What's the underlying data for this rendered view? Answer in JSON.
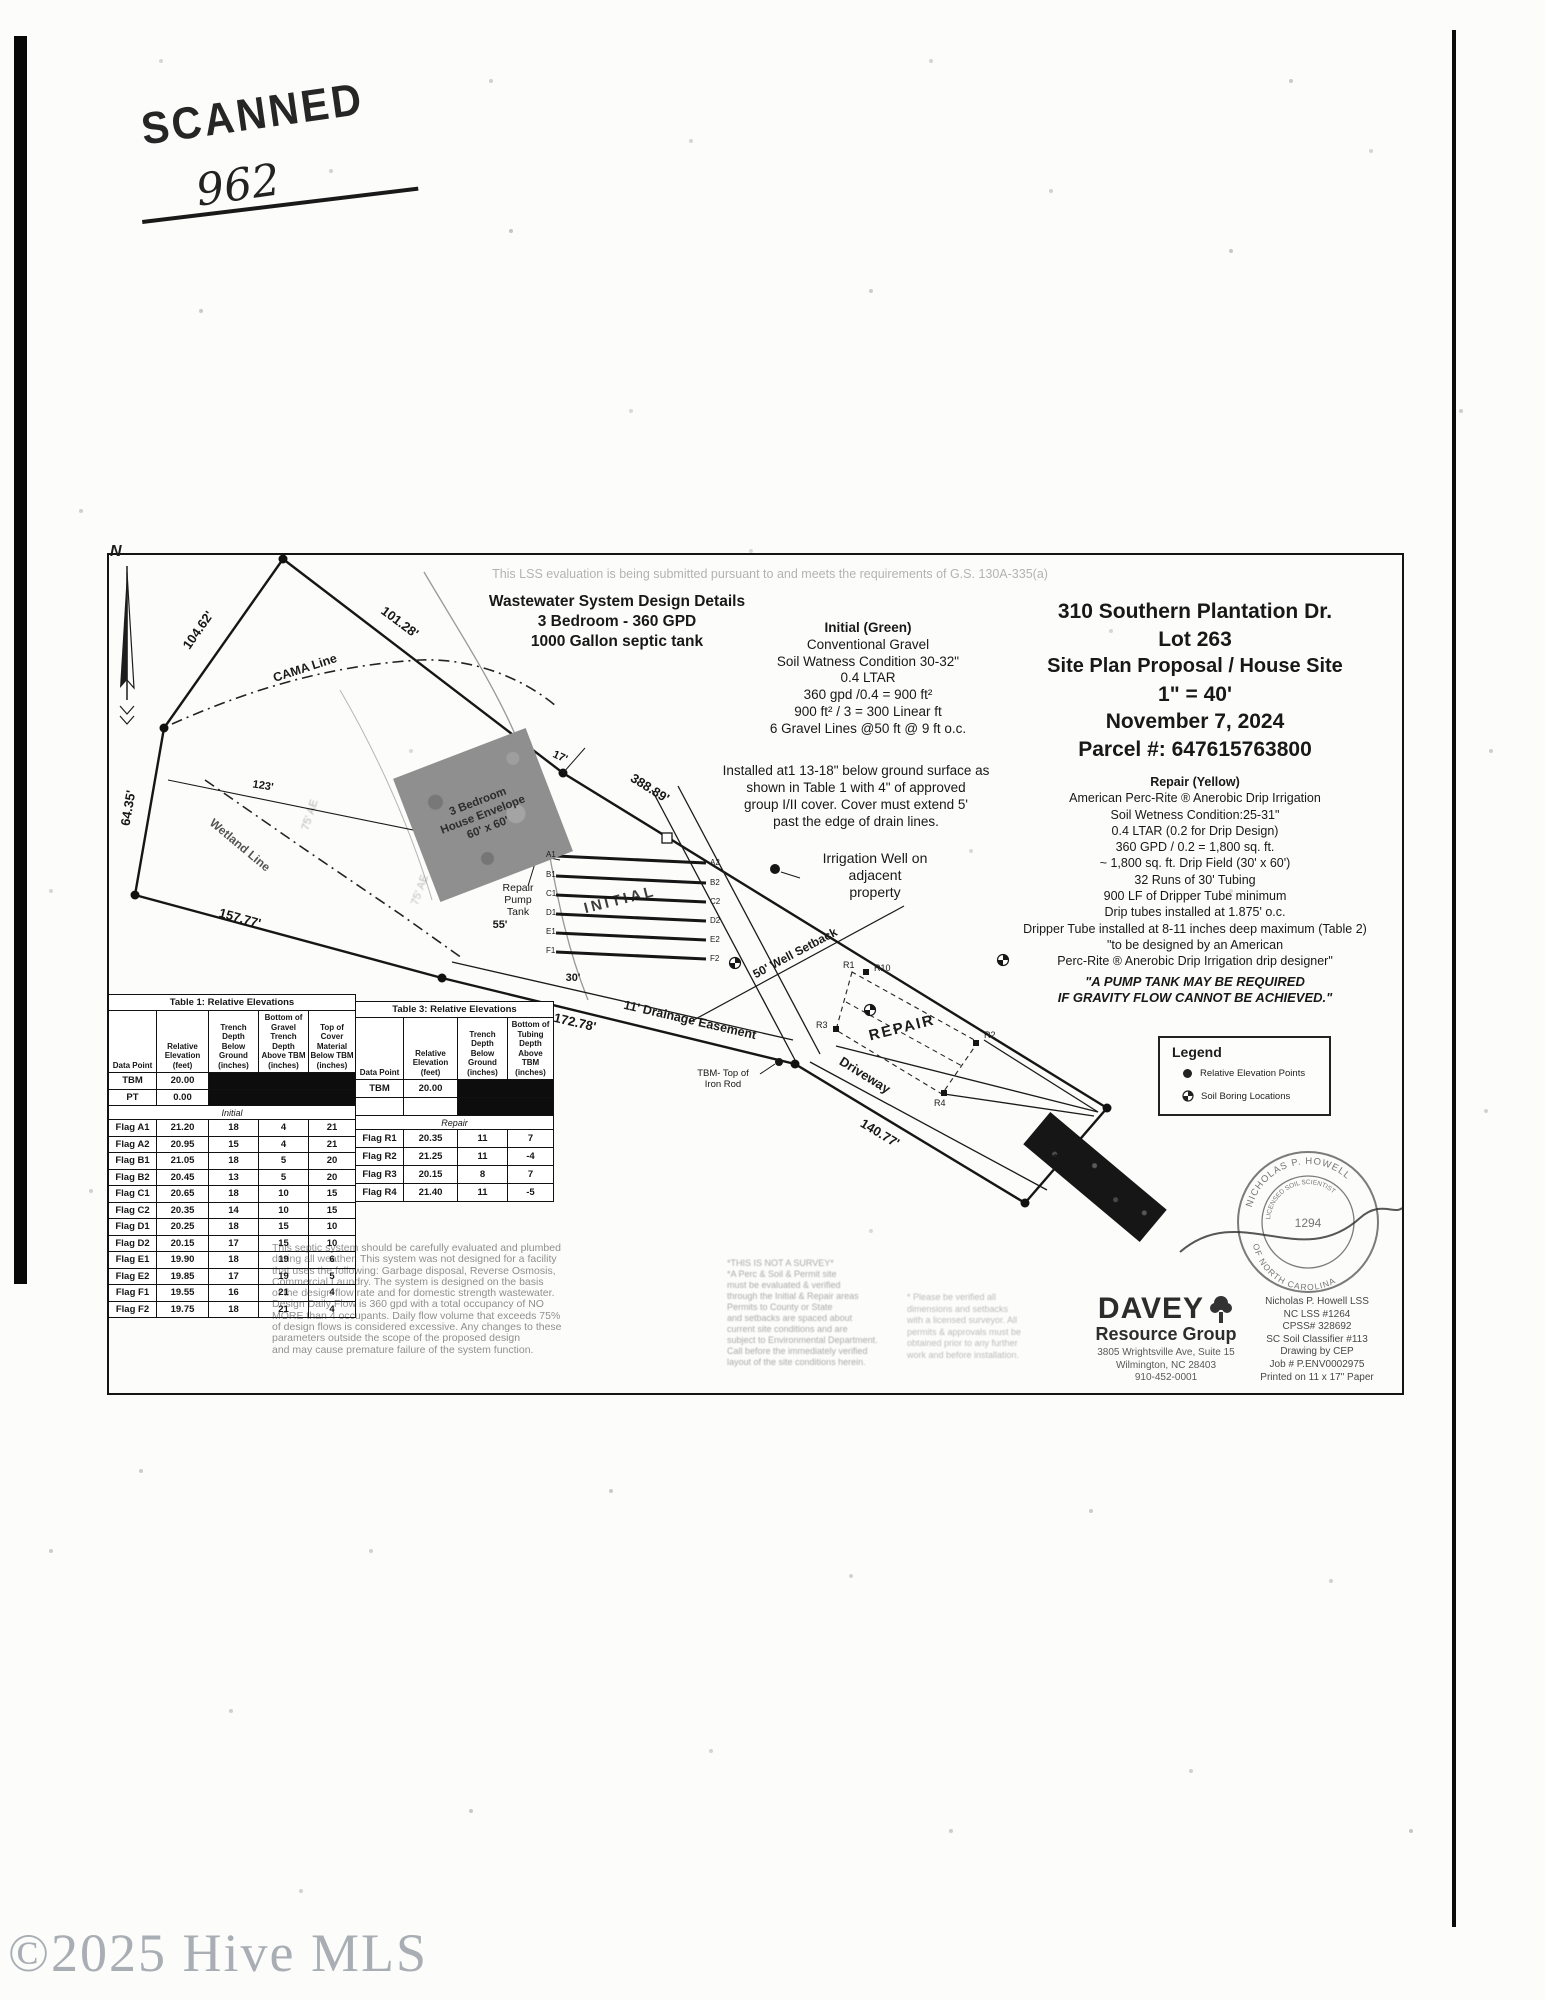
{
  "stamp": {
    "scanned": "SCANNED",
    "number": "962"
  },
  "watermark": "©2025 Hive MLS",
  "plan": {
    "compliance_note": "This LSS evaluation is being submitted pursuant to and meets the requirements of G.S. 130A-335(a)",
    "north": "N",
    "design": {
      "l1": "Wastewater System Design Details",
      "l2": "3 Bedroom - 360 GPD",
      "l3": "1000 Gallon septic tank"
    },
    "initial": {
      "title": "Initial (Green)",
      "lines": [
        "Conventional Gravel",
        "Soil Watness Condition 30-32\"",
        "0.4 LTAR",
        "360 gpd /0.4 = 900 ft²",
        "900 ft² / 3 = 300 Linear ft",
        "6 Gravel Lines @50 ft @ 9 ft o.c."
      ],
      "note": [
        "Installed at1 13-18\" below ground surface as",
        "shown in Table 1 with 4\" of approved",
        "group I/II cover. Cover must extend 5'",
        "past the edge of drain lines."
      ]
    },
    "title_block": {
      "address": "310 Southern Plantation Dr.",
      "lot": "Lot 263",
      "subtitle": "Site Plan Proposal / House Site",
      "scale": "1\" = 40'",
      "date": "November 7, 2024",
      "parcel": "Parcel #: 647615763800"
    },
    "repair": {
      "title": "Repair (Yellow)",
      "lines": [
        "American Perc-Rite ® Anerobic Drip Irrigation",
        "Soil Wetness Condition:25-31\"",
        "0.4 LTAR (0.2 for Drip Design)",
        "360 GPD / 0.2 = 1,800 sq. ft.",
        "~ 1,800 sq. ft. Drip Field (30' x 60')",
        "32 Runs of 30' Tubing",
        "900 LF of Dripper Tube minimum",
        "Drip tubes installed at 1.875' o.c.",
        "Dripper Tube installed at 8-11 inches deep maximum (Table 2)",
        "\"to be designed by an American",
        "Perc-Rite ® Anerobic Drip Irrigation drip designer\""
      ],
      "warn1": "\"A PUMP TANK MAY BE REQUIRED",
      "warn2": "IF GRAVITY FLOW CANNOT BE ACHIEVED.\""
    },
    "labels": {
      "d10462": "104.62'",
      "d10128": "101.28'",
      "d6435": "64.35'",
      "d15777": "157.77'",
      "d17278": "172.78'",
      "d14077": "140.77'",
      "d6262": "62.62'",
      "d38889": "388.89'",
      "d17": "17'",
      "d123": "123'",
      "d55": "55'",
      "d30": "30'",
      "cama": "CAMA Line",
      "wetland": "Wetland Line",
      "stream": "75' AE",
      "env1": "3 Bedroom",
      "env2": "House Envelope",
      "env3": "60' x 60'",
      "pump1": "Repair",
      "pump2": "Pump",
      "pump3": "Tank",
      "initial_field": "INITIAL",
      "repair_field": "REPAIR",
      "easement": "11' Drainage Easement",
      "well1": "Irrigation Well on",
      "well2": "adjacent",
      "well3": "property",
      "setback": "50' Well Setback",
      "driveway": "Driveway",
      "tbm1": "TBM- Top of",
      "tbm2": "Iron Rod"
    },
    "flags": {
      "left": [
        "A1",
        "B1",
        "C1",
        "D1",
        "E1",
        "F1"
      ],
      "right": [
        "A2",
        "B2",
        "C2",
        "D2",
        "E2",
        "F2"
      ],
      "r1": "R1",
      "r10": "R10",
      "r2": "R2",
      "r3": "R3",
      "r4": "R4"
    }
  },
  "legend": {
    "title": "Legend",
    "item1": "Relative Elevation Points",
    "item2": "Soil Boring Locations"
  },
  "table1": {
    "title": "Table 1: Relative Elevations",
    "columns": [
      "Data Point",
      "Relative Elevation (feet)",
      "Trench Depth Below Ground (inches)",
      "Bottom of Gravel Trench Depth Above TBM (inches)",
      "Top of Cover Material Below TBM (inches)"
    ],
    "tbm": [
      "TBM",
      "20.00"
    ],
    "pt": [
      "PT",
      "0.00"
    ],
    "section": "Initial",
    "rows": [
      [
        "Flag A1",
        "21.20",
        "18",
        "4",
        "21"
      ],
      [
        "Flag A2",
        "20.95",
        "15",
        "4",
        "21"
      ],
      [
        "Flag B1",
        "21.05",
        "18",
        "5",
        "20"
      ],
      [
        "Flag B2",
        "20.45",
        "13",
        "5",
        "20"
      ],
      [
        "Flag C1",
        "20.65",
        "18",
        "10",
        "15"
      ],
      [
        "Flag C2",
        "20.35",
        "14",
        "10",
        "15"
      ],
      [
        "Flag D1",
        "20.25",
        "18",
        "15",
        "10"
      ],
      [
        "Flag D2",
        "20.15",
        "17",
        "15",
        "10"
      ],
      [
        "Flag E1",
        "19.90",
        "18",
        "19",
        "6"
      ],
      [
        "Flag E2",
        "19.85",
        "17",
        "19",
        "5"
      ],
      [
        "Flag F1",
        "19.55",
        "16",
        "21",
        "4"
      ],
      [
        "Flag F2",
        "19.75",
        "18",
        "21",
        "4"
      ]
    ]
  },
  "table3": {
    "title": "Table 3: Relative Elevations",
    "columns": [
      "Data Point",
      "Relative Elevation (feet)",
      "Trench Depth Below Ground (inches)",
      "Bottom of Tubing Depth Above TBM (inches)"
    ],
    "tbm": [
      "TBM",
      "20.00"
    ],
    "section": "Repair",
    "rows": [
      [
        "Flag R1",
        "20.35",
        "11",
        "7"
      ],
      [
        "Flag R2",
        "21.25",
        "11",
        "-4"
      ],
      [
        "Flag R3",
        "20.15",
        "8",
        "7"
      ],
      [
        "Flag R4",
        "21.40",
        "11",
        "-5"
      ]
    ]
  },
  "disclaimer": {
    "lines": [
      "This septic system should be carefully evaluated and plumbed",
      "during all weather. This system was not designed for a facility",
      "that uses the following: Garbage disposal, Reverse Osmosis,",
      "Commercial Laundry. The system is designed on the basis",
      "of the design flow rate and for domestic strength wastewater.",
      "Design Daily Flow is 360 gpd with a total occupancy of NO",
      "MORE than 4 occupants. Daily flow volume that exceeds 75%",
      "of design flows is considered excessive. Any changes to these",
      "parameters outside the scope of the proposed design",
      "and may cause premature failure of the system function."
    ]
  },
  "notes": {
    "note1_lines": [
      "*THIS IS NOT A SURVEY*",
      "*A Perc & Soil & Permit site",
      "must be evaluated & verified",
      "through the Initial & Repair areas",
      "Permits to County or State",
      "and setbacks are spaced about",
      "current site conditions and are",
      "subject to Environmental Department.",
      "Call before the immediately verified",
      "layout of the site conditions herein."
    ],
    "note2_lines": [
      "* Please be verified all",
      "dimensions and setbacks",
      "with a licensed surveyor. All",
      "permits & approvals must be",
      "obtained prior to any further",
      "work and before installation."
    ]
  },
  "firm": {
    "name": "DAVEY",
    "division": "Resource Group",
    "addr1": "3805 Wrightsville Ave, Suite 15",
    "addr2": "Wilmington, NC 28403",
    "phone": "910-452-0001"
  },
  "credentials": {
    "lines": [
      "Nicholas P. Howell LSS",
      "NC LSS #1264",
      "CPSS# 328692",
      "SC Soil Classifier #113",
      "Drawing by CEP",
      "Job # P.ENV0002975",
      "Printed on 11 x 17\" Paper"
    ]
  },
  "seal": {
    "arc_top": "NICHOLAS P. HOWELL",
    "arc_bottom": "OF NORTH CAROLINA",
    "mid": "LICENSED SOIL SCIENTIST",
    "center": "1294"
  }
}
